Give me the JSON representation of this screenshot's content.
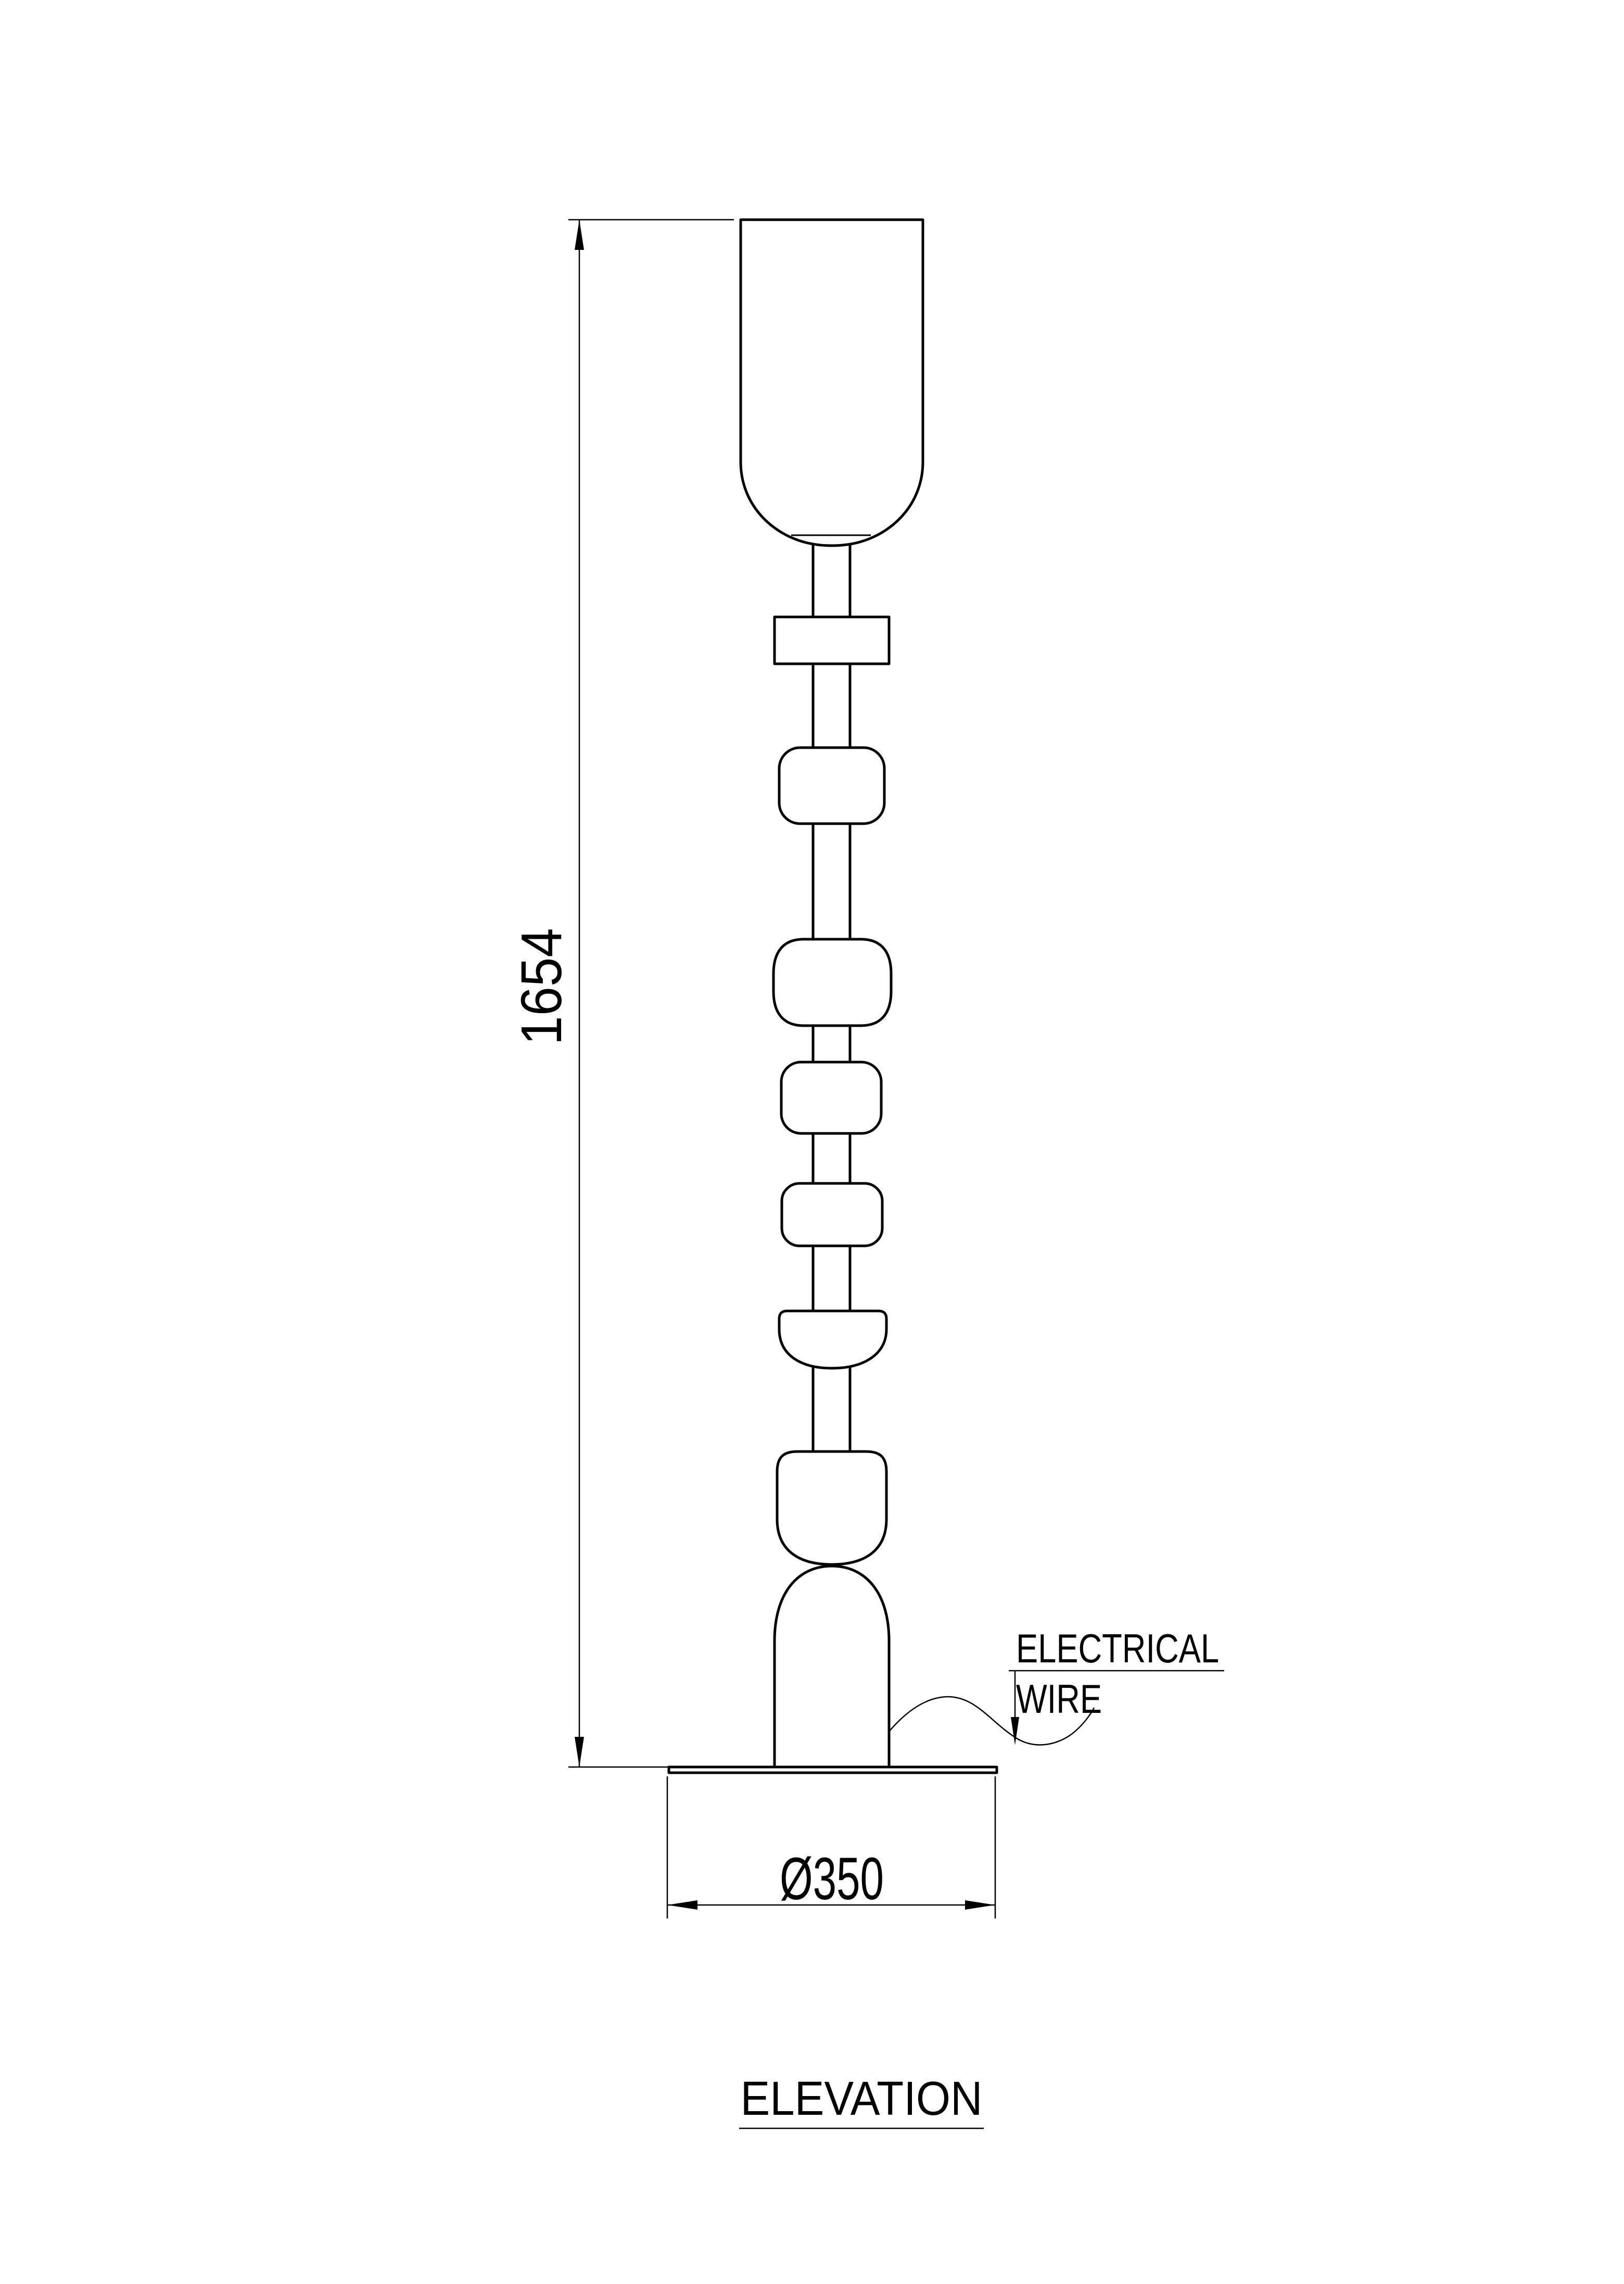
{
  "page": {
    "background_color": "#ffffff",
    "line_color": "#000000"
  },
  "title": {
    "text": "ELEVATION"
  },
  "dimensions": {
    "height": {
      "value": "1654"
    },
    "base_diameter": {
      "value": "Ø350"
    }
  },
  "labels": {
    "wire_line1": "ELECTRICAL",
    "wire_line2": "WIRE"
  }
}
